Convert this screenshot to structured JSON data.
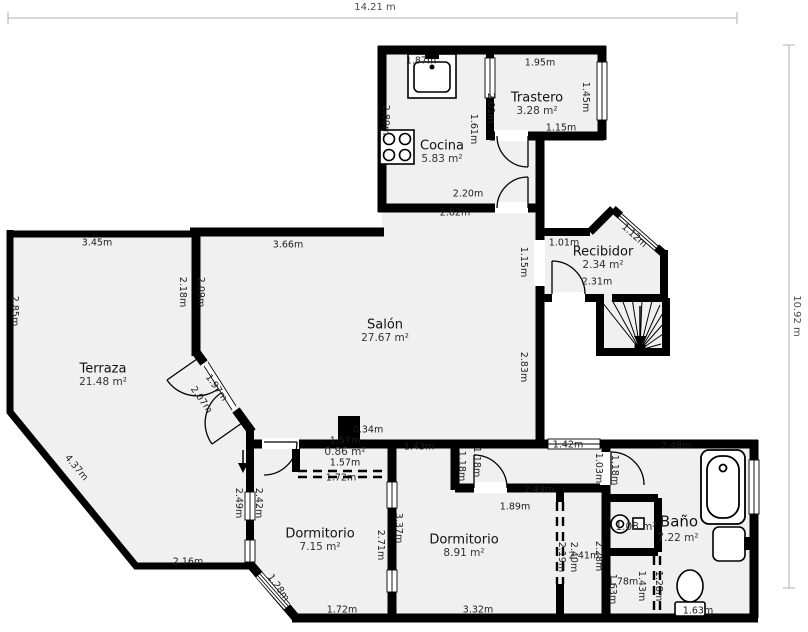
{
  "plan": {
    "overall_width": "14.21 m",
    "overall_height": "10.92 m",
    "rooms": [
      {
        "name": "Salón",
        "area": "27.67 m²"
      },
      {
        "name": "Terraza",
        "area": "21.48 m²"
      },
      {
        "name": "Cocina",
        "area": "5.83 m²"
      },
      {
        "name": "Trastero",
        "area": "3.28 m²"
      },
      {
        "name": "Recibidor",
        "area": "2.34 m²"
      },
      {
        "name": "Dormitorio",
        "area": "7.15 m²"
      },
      {
        "name": "Dormitorio",
        "area": "8.91 m²"
      },
      {
        "name": "Baño",
        "area": "7.22 m²"
      }
    ],
    "small_areas": [
      "0.86 m²",
      "1.08 m²"
    ],
    "dims": [
      "14.21 m",
      "10.92 m",
      "3.45m",
      "2.85m",
      "4.37m",
      "2.16m",
      "2.18m",
      "2.09m",
      "3.66m",
      "1.97m",
      "2.07m",
      "2.80m",
      "1.87m",
      "1.95m",
      "1.45m",
      "1.15m",
      "2.01m",
      "1.61m",
      "2.20m",
      "2.82m",
      "1.01m",
      "1.12m",
      "2.31m",
      "1.15m",
      "2.83m",
      "0.34m",
      "1.43m",
      "1.57m",
      "1.57m",
      "1.72m",
      "1.42m",
      "2.48m",
      "1.03m",
      "1.18m",
      "1.18m",
      "1.18m",
      "2.49m",
      "1.89m",
      "2.49m",
      "2.42m",
      "1.28m",
      "2.71m",
      "3.37m",
      "1.72m",
      "3.32m",
      "2.19m",
      "2.40m",
      "2.41m",
      "2.28m",
      "1.78m",
      "1.63m",
      "1.43m",
      "1.28m",
      "1.63m"
    ],
    "colors": {
      "wall": "#000000",
      "floor": "#f0f0f0",
      "dimension_line": "#b0b0b0"
    }
  }
}
